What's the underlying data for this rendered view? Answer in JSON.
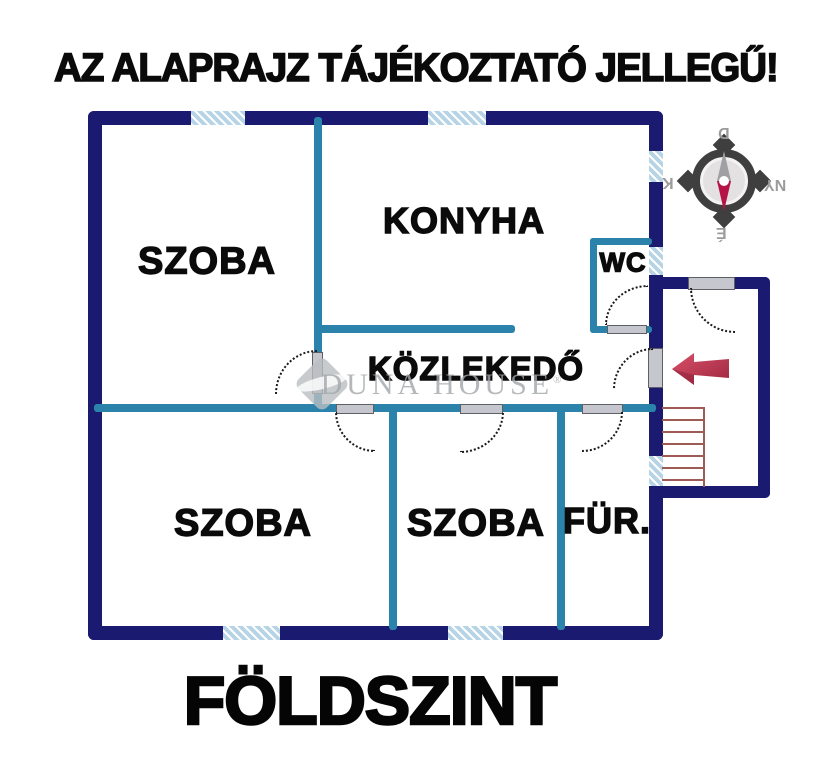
{
  "title": "AZ ALAPRAJZ TÁJÉKOZTATÓ JELLEGŰ!",
  "floor_label": "FÖLDSZINT",
  "rooms": {
    "room_top_left": "SZOBA",
    "kitchen": "KONYHA",
    "wc": "WC",
    "hallway": "KÖZLEKEDŐ",
    "room_bottom_left": "SZOBA",
    "room_bottom_middle": "SZOBA",
    "bathroom": "FÜR."
  },
  "compass": {
    "top": "D",
    "bottom": "É",
    "left": "K",
    "right": "NY"
  },
  "watermark": {
    "brand": "DUNA HOUSE",
    "registered": "®"
  },
  "colors": {
    "outer_wall": "#1a1a70",
    "inner_wall": "#2b83ac",
    "window": "#b7d3e6",
    "stairs": "#9e5a55",
    "entrance_arrow": "#c93352",
    "compass_needle_north": "#b61346",
    "watermark_gray": "#a2a7aa"
  }
}
